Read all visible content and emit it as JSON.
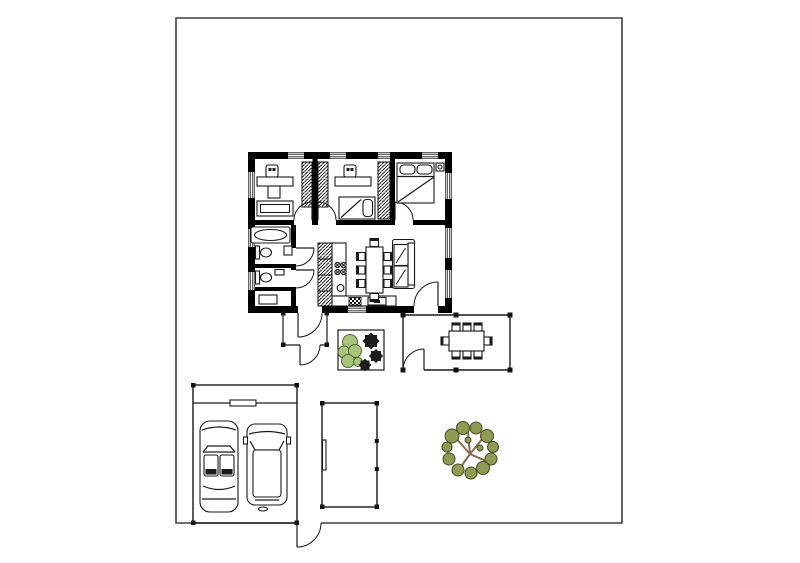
{
  "plan": {
    "visible_text": [],
    "site": {
      "boundary": "rectangular property line",
      "outbuildings": [
        "garage",
        "carport"
      ],
      "outdoor_features": [
        "entry porch",
        "terrace with dining set",
        "planter bed with bushes and shrubs",
        "large tree",
        "garden gate beside garage",
        "terrace gate"
      ]
    },
    "house": {
      "rooms": [
        {
          "name": "office",
          "furniture": [
            "desk",
            "desk chair",
            "sideboard",
            "wardrobe"
          ]
        },
        {
          "name": "small bedroom",
          "furniture": [
            "desk",
            "desk chair",
            "single bed",
            "wardrobe",
            "wardrobe"
          ]
        },
        {
          "name": "master bedroom",
          "furniture": [
            "double bed",
            "two pillows",
            "nightstand with lamp"
          ]
        },
        {
          "name": "bathroom",
          "furniture": [
            "bathtub",
            "toilet",
            "washbasin"
          ]
        },
        {
          "name": "wc",
          "furniture": [
            "toilet",
            "washbasin"
          ]
        },
        {
          "name": "hall",
          "furniture": [
            "cabinet"
          ]
        },
        {
          "name": "living-dining-kitchen",
          "furniture": [
            "dining table",
            "eight chairs",
            "sofa with two cushions",
            "tall kitchen cabinet",
            "kitchen counter",
            "stove burners",
            "sink",
            "appliance"
          ]
        }
      ],
      "doors": [
        "office door",
        "small-bedroom door",
        "master-bedroom door",
        "bathroom door",
        "wc door",
        "back door to porch",
        "porch outer door",
        "main entrance door"
      ],
      "windows": [
        "4 on north wall",
        "3 on west wall",
        "3 on east wall",
        "1 on south wall"
      ]
    },
    "counts": {
      "cars_in_garage": 2,
      "indoor_dining_chairs": 8,
      "terrace_chairs": 8,
      "beds": 2,
      "toilets": 2,
      "wardrobe_columns": 3,
      "desks": 2,
      "trees": 1,
      "green_bushes": 5,
      "dark_shrubs": 3
    }
  },
  "colors": {
    "background": "#ffffff",
    "wall": "#000000",
    "line": "#1a1a1a",
    "boundary": "#3f3f3f",
    "tree_foliage": "#8f9a55",
    "tree_branch": "#8a6a4e",
    "bush": "#a9c47e",
    "bush_outline": "#4e6a2d",
    "shrub": "#1d1d1d"
  }
}
